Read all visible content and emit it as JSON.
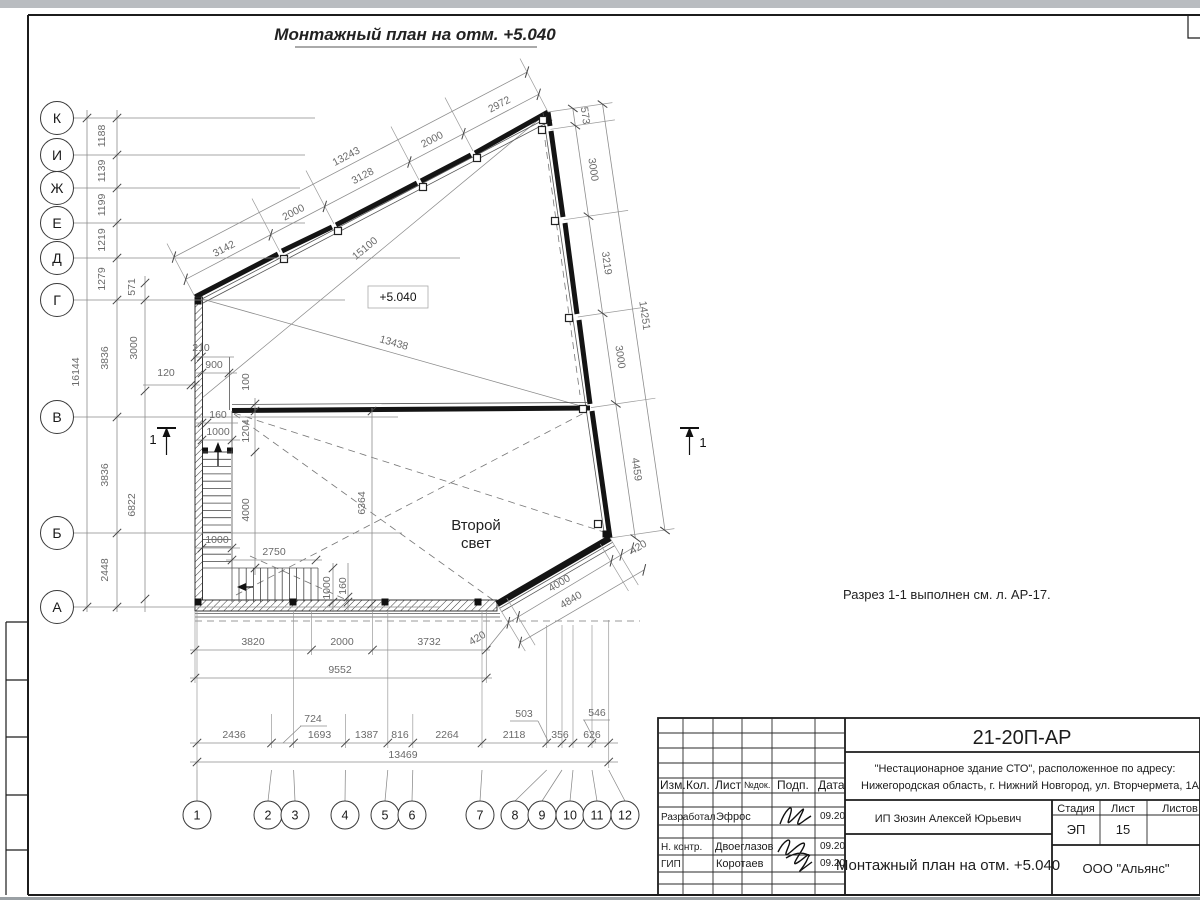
{
  "page": {
    "title": "Монтажный план на отм. +5.040",
    "note": "Разрез 1-1 выполнен см. л. АР-17.",
    "elevation": "+5.040",
    "second_light_line1": "Второй",
    "second_light_line2": "свет",
    "section_mark": "1"
  },
  "axes": {
    "left": [
      "К",
      "И",
      "Ж",
      "Е",
      "Д",
      "Г",
      "В",
      "Б",
      "А"
    ],
    "bottom": [
      "1",
      "2",
      "3",
      "4",
      "5",
      "6",
      "7",
      "8",
      "9",
      "10",
      "11",
      "12"
    ]
  },
  "dims": {
    "left_fine": [
      "1188",
      "1139",
      "1199",
      "1219",
      "1279"
    ],
    "left_total": "16144",
    "left_mid": [
      "3836",
      "3836",
      "2448"
    ],
    "left_inner": [
      "571",
      "3000",
      "6822"
    ],
    "d120": "120",
    "top_chain": [
      "3142",
      "2000",
      "3128",
      "2000",
      "2972"
    ],
    "top_total": "13243",
    "right_chain": [
      "573",
      "3000",
      "3219",
      "3000",
      "4459"
    ],
    "right_total": "14251",
    "diag_long": "15100",
    "diag_short": "13438",
    "chamfer": {
      "lower_420": "420",
      "mid_4000": "4000",
      "total_4840": "4840",
      "upper_420": "420"
    },
    "bottom_a": [
      "3820",
      "2000",
      "3732"
    ],
    "bottom_total": "9552",
    "bottom_b": [
      "2436",
      "1693",
      "1387",
      "816",
      "2264",
      "2118",
      "356",
      "626"
    ],
    "bottom_b_raised": [
      "724",
      "503",
      "546"
    ],
    "bottom_b_total": "13469",
    "stair": {
      "d210": "210",
      "d900": "900",
      "d100": "100",
      "d160a": "160",
      "d1000a": "1000",
      "d1204": "1204",
      "d4000": "4000",
      "d1000b": "1000",
      "d2750": "2750",
      "d6364": "6364",
      "d1000c": "1000",
      "d160b": "160"
    }
  },
  "titleblock": {
    "doc_number": "21-20П-АР",
    "address_line1": "\"Нестационарное здание СТО\", расположенное по адресу:",
    "address_line2": "Нижегородская область, г. Нижний Новгород, ул. Вторчермета, 1А",
    "client": "ИП Зюзин Алексей Юрьевич",
    "sheet_title": "Монтажный план на отм. +5.040",
    "company": "ООО \"Альянс\"",
    "header": {
      "izm": "Изм.",
      "kol": "Кол.",
      "list": "Лист",
      "ndok": "№док.",
      "podp": "Подп.",
      "data": "Дата"
    },
    "stage_header": {
      "stage": "Стадия",
      "sheet": "Лист",
      "sheets": "Листов"
    },
    "stage_value": "ЭП",
    "sheet_value": "15",
    "roles": [
      {
        "role": "Разработал",
        "name": "Эфрос",
        "date": "09.20"
      },
      {
        "role": "Н. контр.",
        "name": "Двоеглазов",
        "date": "09.20"
      },
      {
        "role": "ГИП",
        "name": "Коротаев",
        "date": "09.20"
      }
    ]
  }
}
